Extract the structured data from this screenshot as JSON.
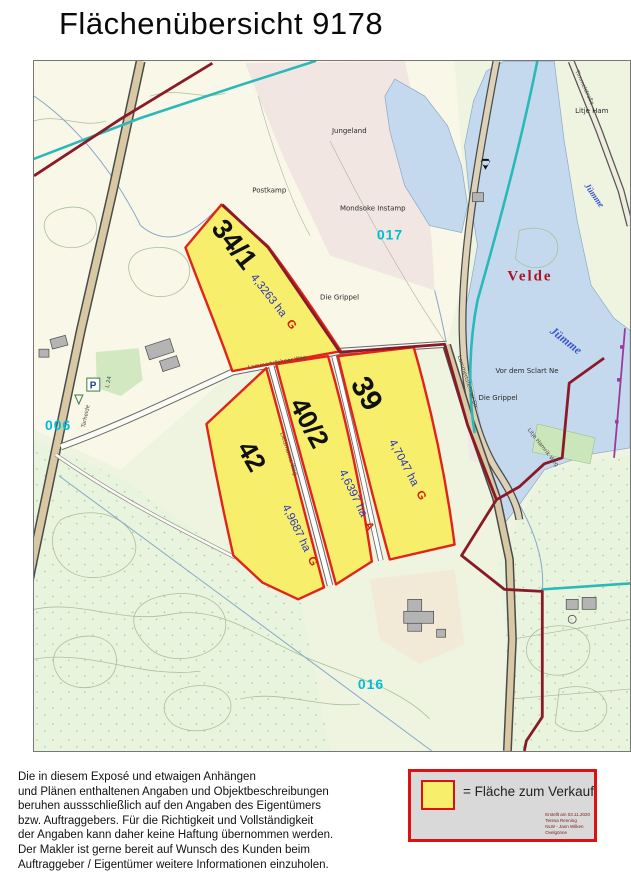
{
  "title": "Flächenübersicht 9178",
  "map": {
    "town_label": "Velde",
    "river_label": "Jümme",
    "parcels": [
      {
        "number": "34/1",
        "area": "4,3263 ha",
        "usage": "G"
      },
      {
        "number": "39",
        "area": "4,7047 ha",
        "usage": "G"
      },
      {
        "number": "40/2",
        "area": "4,6397 ha",
        "usage": "A"
      },
      {
        "number": "42",
        "area": "4,9687 ha",
        "usage": "G"
      }
    ],
    "flur_numbers": [
      "006",
      "017",
      "016"
    ],
    "place_labels": [
      "Jungeland",
      "Postkamp",
      "Mondsoke Instamp",
      "Die Grippel",
      "Die Grippel",
      "Vor dem Sclart Ne",
      "Litje Ham"
    ],
    "road_labels": [
      "Tarheide",
      "L 24",
      "Lammertsfehner Weg",
      "Lietzmanns Weg",
      "Lammertsfehner Str.",
      "Timmelstraße",
      "Litje Hamrik Weg"
    ],
    "parking_letter": "P",
    "colors": {
      "parcel_fill": "#f7ef6b",
      "parcel_border": "#e2231a",
      "boundary": "#8a1a28",
      "water": "#c5d9ee",
      "flur_number": "#00bdd6",
      "town": "#a81421",
      "area_text": "#2a35c0",
      "usage_text": "#d42000"
    }
  },
  "legend": {
    "label": "= Fläche zum Verkauf",
    "stamp_lines": [
      "Erstellt am 03.11.2020",
      "Teresa Renning",
      "NLW - Jann Wilken",
      "Ovelgönne"
    ]
  },
  "disclaimer": {
    "lines": [
      "Die in diesem Exposé und etwaigen Anhängen",
      "und Plänen enthaltenen Angaben und Objektbeschreibungen",
      "beruhen aussschließlich auf den Angaben des Eigentümers",
      "bzw. Auftraggebers. Für die Richtigkeit und Vollständigkeit",
      "der Angaben kann daher keine Haftung übernommen werden.",
      "Der Makler ist gerne bereit auf Wunsch des Kunden beim",
      "Auftraggeber / Eigentümer weitere Informationen einzuholen."
    ]
  }
}
